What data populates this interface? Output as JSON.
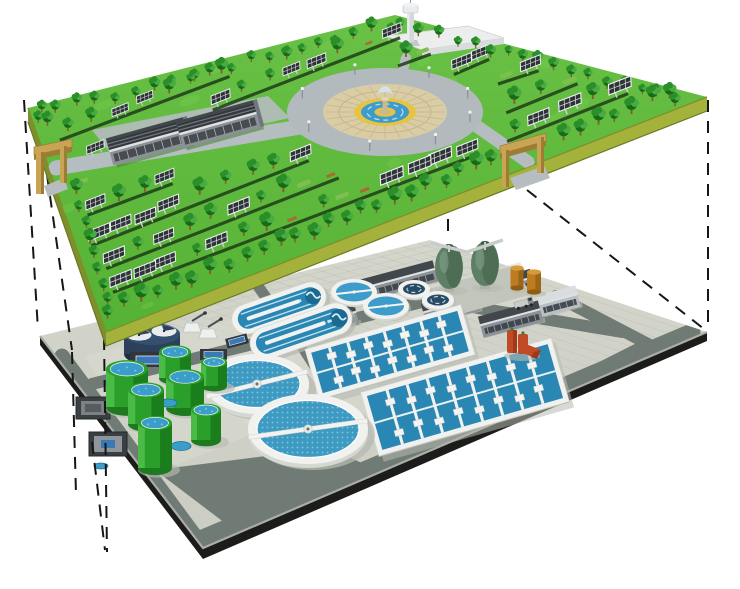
{
  "colors": {
    "background": "#ffffff",
    "dash_line": "#161616",
    "grass": "#55b234",
    "grass_top": "#69c146",
    "grass_light": "#7ccf57",
    "deck_side": "#a4b23c",
    "deck_side_dark": "#7f8f2c",
    "deck_edge_line": "#6a7a22",
    "tree_dark": "#156c15",
    "tree_mid": "#2a8f28",
    "tree_light": "#4aab45",
    "trunk": "#8a5a2e",
    "row_strip": "#1e3d18",
    "panel_dark": "#2e3338",
    "panel_frame": "#f2f4f5",
    "panel_grid": "#e8eaec",
    "panel_post": "#c9ced2",
    "bench": "#a86a2f",
    "hedge": "#7fbf4f",
    "road_upper": "#b6bdc0",
    "plaza_ring": "#b3babd",
    "plaza_pave": "#dacda6",
    "plaza_spoke": "#c7b88a",
    "plaza_yellow": "#e7c343",
    "plaza_water": "#3d9cc9",
    "plaza_water_line": "#bfe0ee",
    "fountain_stone": "#cbb98e",
    "fountain_spray": "#d4e7ee",
    "building_wall": "#8b9196",
    "building_roof": "#42474c",
    "building_roof_dark": "#313539",
    "building_ridge": "#7d848a",
    "building_trim": "#dfe2e3",
    "building_window": "#3a3f43",
    "gate_tan": "#c9a455",
    "gate_tan_dark": "#9e7c34",
    "tower_light": "#e8ecee",
    "tower_mid": "#d4d8da",
    "tower_shade": "#c3c8cb",
    "white_roof": "#eceeee",
    "white_wall": "#d8dcdc",
    "tile": "#cbcdc3",
    "tile_top": "#d4d6cc",
    "tile_line": "#bdbfb5",
    "tile_light": "#d8dacf",
    "plat_road": "#6f7b74",
    "edge_black": "#1c1c1a",
    "edge_light": "#a9aea6",
    "concrete": "#f1f2f0",
    "concrete_edge": "#d5d7d1",
    "concrete_shadow": "#b4b8ae",
    "water": "#2a87b4",
    "water_deep": "#1a6a92",
    "water_dot_base": "#3f9ac2",
    "water_dot": "#7fc9e4",
    "egg_body": "#5e7f66",
    "egg_dark": "#4a6a52",
    "egg_light": "#7b9a82",
    "egg_cap": "#3c5a44",
    "walkway_gray": "#c9cdc9",
    "orange_tank": "#bc7c20",
    "orange_tank_light": "#d89a3a",
    "orange_tank_dark": "#8f5d14",
    "red_unit": "#c14a26",
    "red_unit_dark": "#8e3012",
    "navy": "#2c4059",
    "navy_light": "#35506e",
    "navy_dark": "#1e2f45",
    "steel": "#555d63",
    "dark_box": "#30363b",
    "blue_screen": "#3a79b8",
    "tank_green": "#2aa02a",
    "tank_green_dark": "#187a1c",
    "tank_green_light": "#51c24e",
    "tank_base": "#1d7a1f",
    "tank_top_blue": "#3b9dc9",
    "shadow": "#b7bab0"
  },
  "scene": {
    "surface_park_layer": {
      "label": "solar-park-ground-level",
      "solar_panel_field": true,
      "perimeter_trees": true,
      "fountain_plaza_count": 1,
      "maintenance_buildings": 2,
      "entrance_gates": 2,
      "observation_tower": 1,
      "service_building": 1
    },
    "underground_plant_layer": {
      "label": "underground-wastewater-treatment-plant",
      "egg_shaped_digesters": 2,
      "orange_storage_silos": 2,
      "oxidation_ditches": 2,
      "small_covered_clarifiers": 4,
      "aeration_basins": 2,
      "secondary_clarifiers": 2,
      "green_sludge_tanks": 7,
      "service_buildings": 6,
      "red_pump_unit": 1,
      "navy_blower_tank": 1,
      "substation_boxes": 2,
      "control_cabinets": 2,
      "hopper_units": 2,
      "utility_truck": 1
    },
    "cutaway_projection_dashed_lines": 8
  }
}
